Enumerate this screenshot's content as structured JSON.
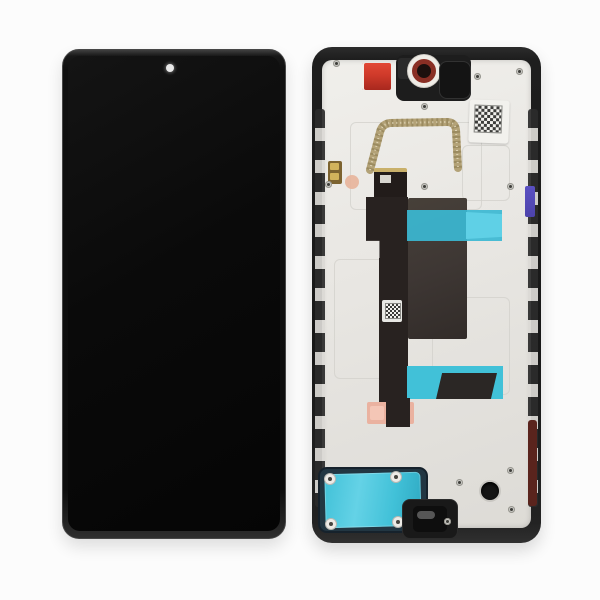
{
  "meta": {
    "front_label": "smartphone-display-assembly-front-view",
    "back_label": "smartphone-display-assembly-back-frame-view"
  },
  "palette": {
    "background": "#fcfcfc",
    "screen": "#0a0a0a",
    "camera_dot": "#e8e8e8",
    "back_frame": "#1e1e1e",
    "frame_dark": "#2b2b2b",
    "plate": "#e9e7e3",
    "plate_line": "#d2d0cb",
    "cyan": "#3bb9d3",
    "cyan_light": "#5fd0e6",
    "cyan_tape2": "#41c1d8",
    "chip": "#3e3734",
    "flex": "#282220",
    "flex_dark": "#221c1a",
    "salmon": "#eab2a0",
    "salmon_light": "#f4c6b6",
    "red_sticker": "#cf3a2a",
    "red_sticker_dark": "#a8281e",
    "gold": "#b3a277",
    "gold_dark": "#8f7f55",
    "gold_pad": "#d2b35c",
    "gold_pad_dark": "#7c6330",
    "peach": "#e8b49a",
    "camera_ring": "#8a2f24",
    "camera_inner": "#1c100d",
    "blue_clip": "#4d43ab",
    "maroon": "#5a241d",
    "qr_dark": "#3c3c3a",
    "label": "#f2f1ed",
    "screw_base": "#c9c8c4",
    "screw_center": "#3e3e3a",
    "speaker_base": "#223642",
    "black_part": "#191919"
  }
}
